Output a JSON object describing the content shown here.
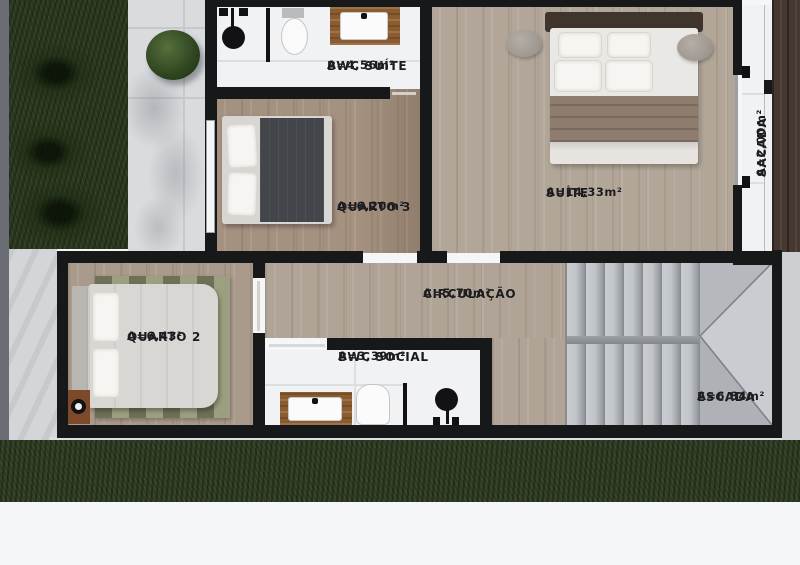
{
  "plan": {
    "title": "upper-floor-plan",
    "rooms": [
      {
        "name": "BWC SUÍTE",
        "area": "A=4,56m²"
      },
      {
        "name": "QUARTO 3",
        "area": "A=6,20m²"
      },
      {
        "name": "SUÍTE",
        "area": "A=14,33m²"
      },
      {
        "name": "SACADA",
        "area": "A=2,00m²"
      },
      {
        "name": "CIRCULAÇÃO",
        "area": "A=5,70m²"
      },
      {
        "name": "QUARTO 2",
        "area": "A=6,43²"
      },
      {
        "name": "BWC SOCIAL",
        "area": "A=3,39m²"
      },
      {
        "name": "ESCADA",
        "area": "A=6,84m²"
      }
    ],
    "colors": {
      "wall": "#17181a",
      "wood_floor": "#b2a698",
      "bath_floor": "#f0f2f3",
      "stairs": "#c2c5c8",
      "grass": "#2c3920",
      "pavement": "#d9dbdd",
      "label_text": "#1b1b1d"
    }
  }
}
